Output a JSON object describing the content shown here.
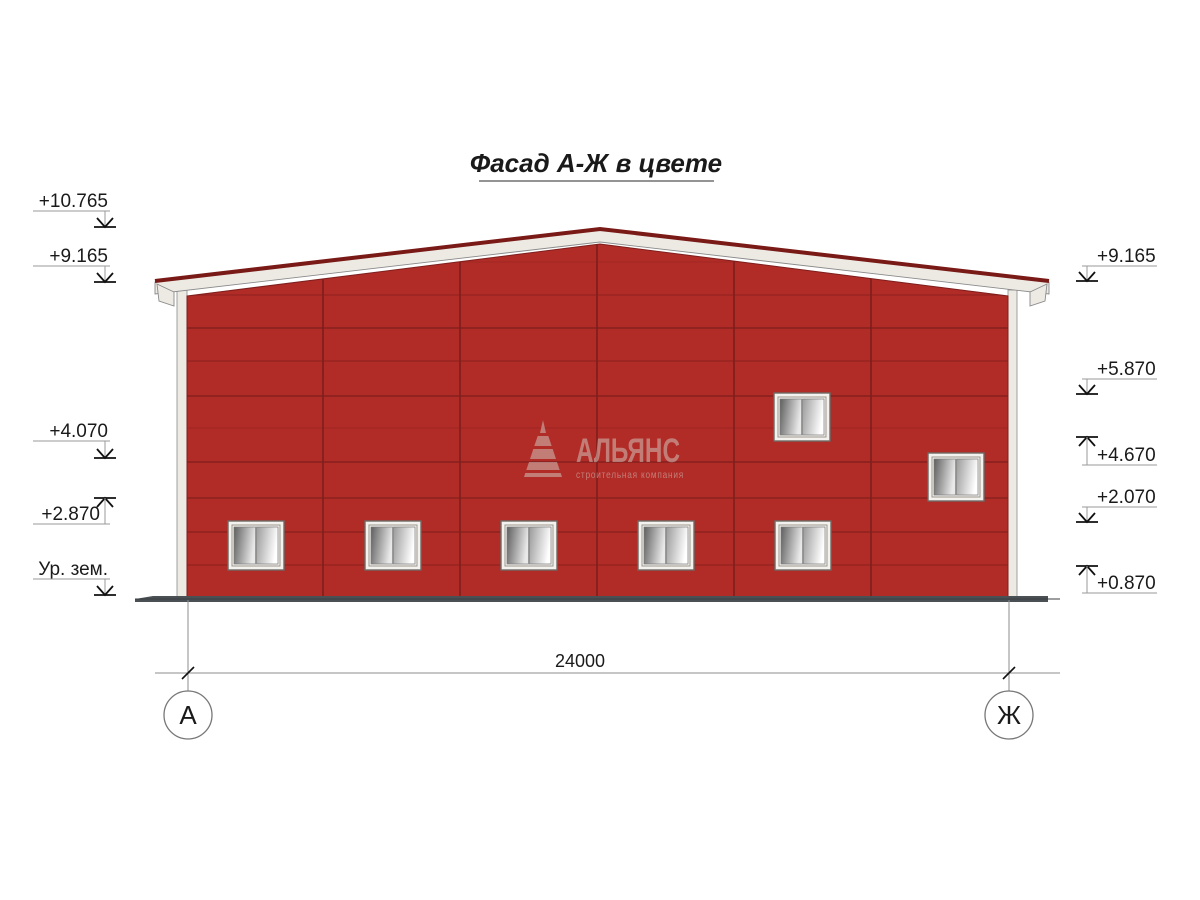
{
  "title": "Фасад А-Ж в цвете",
  "watermark": {
    "name": "АЛЬЯНС",
    "tagline": "строительная компания"
  },
  "dimensions": {
    "overall_width": "24000"
  },
  "axis_markers": {
    "left": "А",
    "right": "Ж"
  },
  "elevations": {
    "left": [
      {
        "label": "+10.765",
        "arrow": "down"
      },
      {
        "label": "+9.165",
        "arrow": "down"
      },
      {
        "label": "+4.070",
        "arrow": "down"
      },
      {
        "label": "+2.870",
        "arrow": "up"
      },
      {
        "label": "Ур. зем.",
        "arrow": "down"
      }
    ],
    "right": [
      {
        "label": "+9.165",
        "arrow": "down"
      },
      {
        "label": "+5.870",
        "arrow": "down"
      },
      {
        "label": "+4.670",
        "arrow": "up"
      },
      {
        "label": "+2.070",
        "arrow": "down"
      },
      {
        "label": "+0.870",
        "arrow": "up"
      }
    ]
  },
  "building": {
    "window_count": 7,
    "bay_count": 6
  },
  "colors": {
    "wall": "#b12b27",
    "wall_seam": "#7e1f1c",
    "roof_cap": "#7a1a17",
    "fascia": "#edeae4",
    "ground": "#4b5055",
    "drawing_line": "#8c8c8c",
    "text": "#1a1a1a"
  }
}
